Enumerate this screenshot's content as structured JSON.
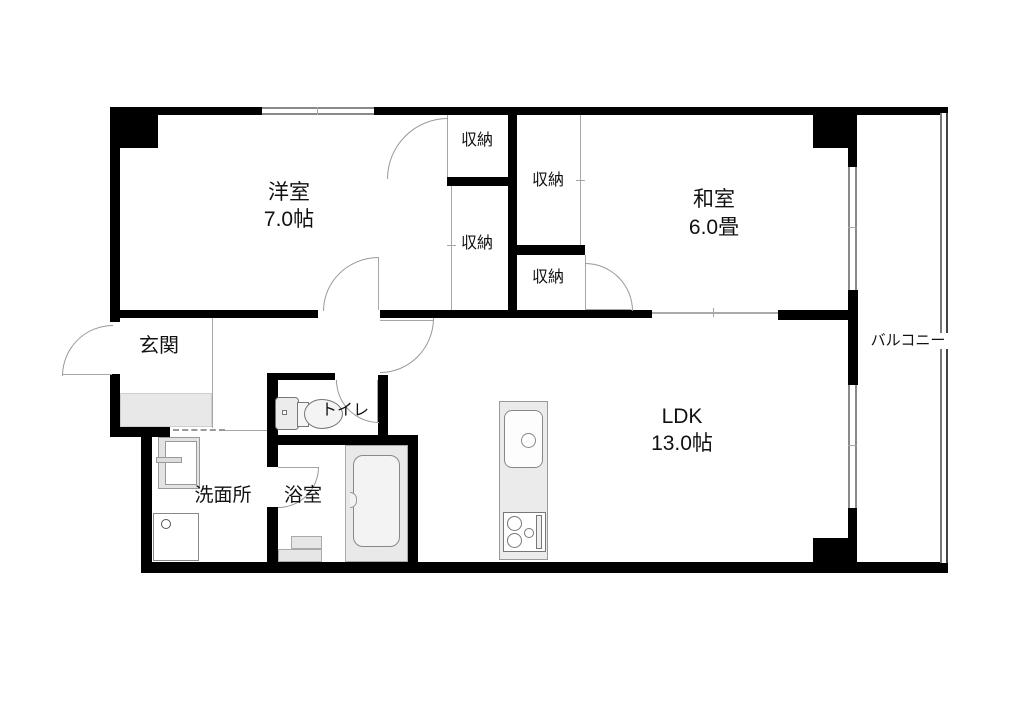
{
  "rooms": {
    "western_room": {
      "name": "洋室",
      "size": "7.0帖"
    },
    "japanese_room": {
      "name": "和室",
      "size": "6.0畳"
    },
    "ldk": {
      "name": "LDK",
      "size": "13.0帖"
    },
    "entrance": {
      "name": "玄関"
    },
    "toilet": {
      "name": "トイレ"
    },
    "washroom": {
      "name": "洗面所"
    },
    "bathroom": {
      "name": "浴室"
    },
    "balcony": {
      "name": "バルコニー"
    }
  },
  "closets": {
    "western_top": "収納",
    "western_bottom": "収納",
    "japanese_top": "収納",
    "japanese_bottom": "収納"
  },
  "colors": {
    "wall": "#000000",
    "thin_line": "#a6a6a6",
    "fixture_fill": "#e9e9e9",
    "label": "#111111"
  }
}
